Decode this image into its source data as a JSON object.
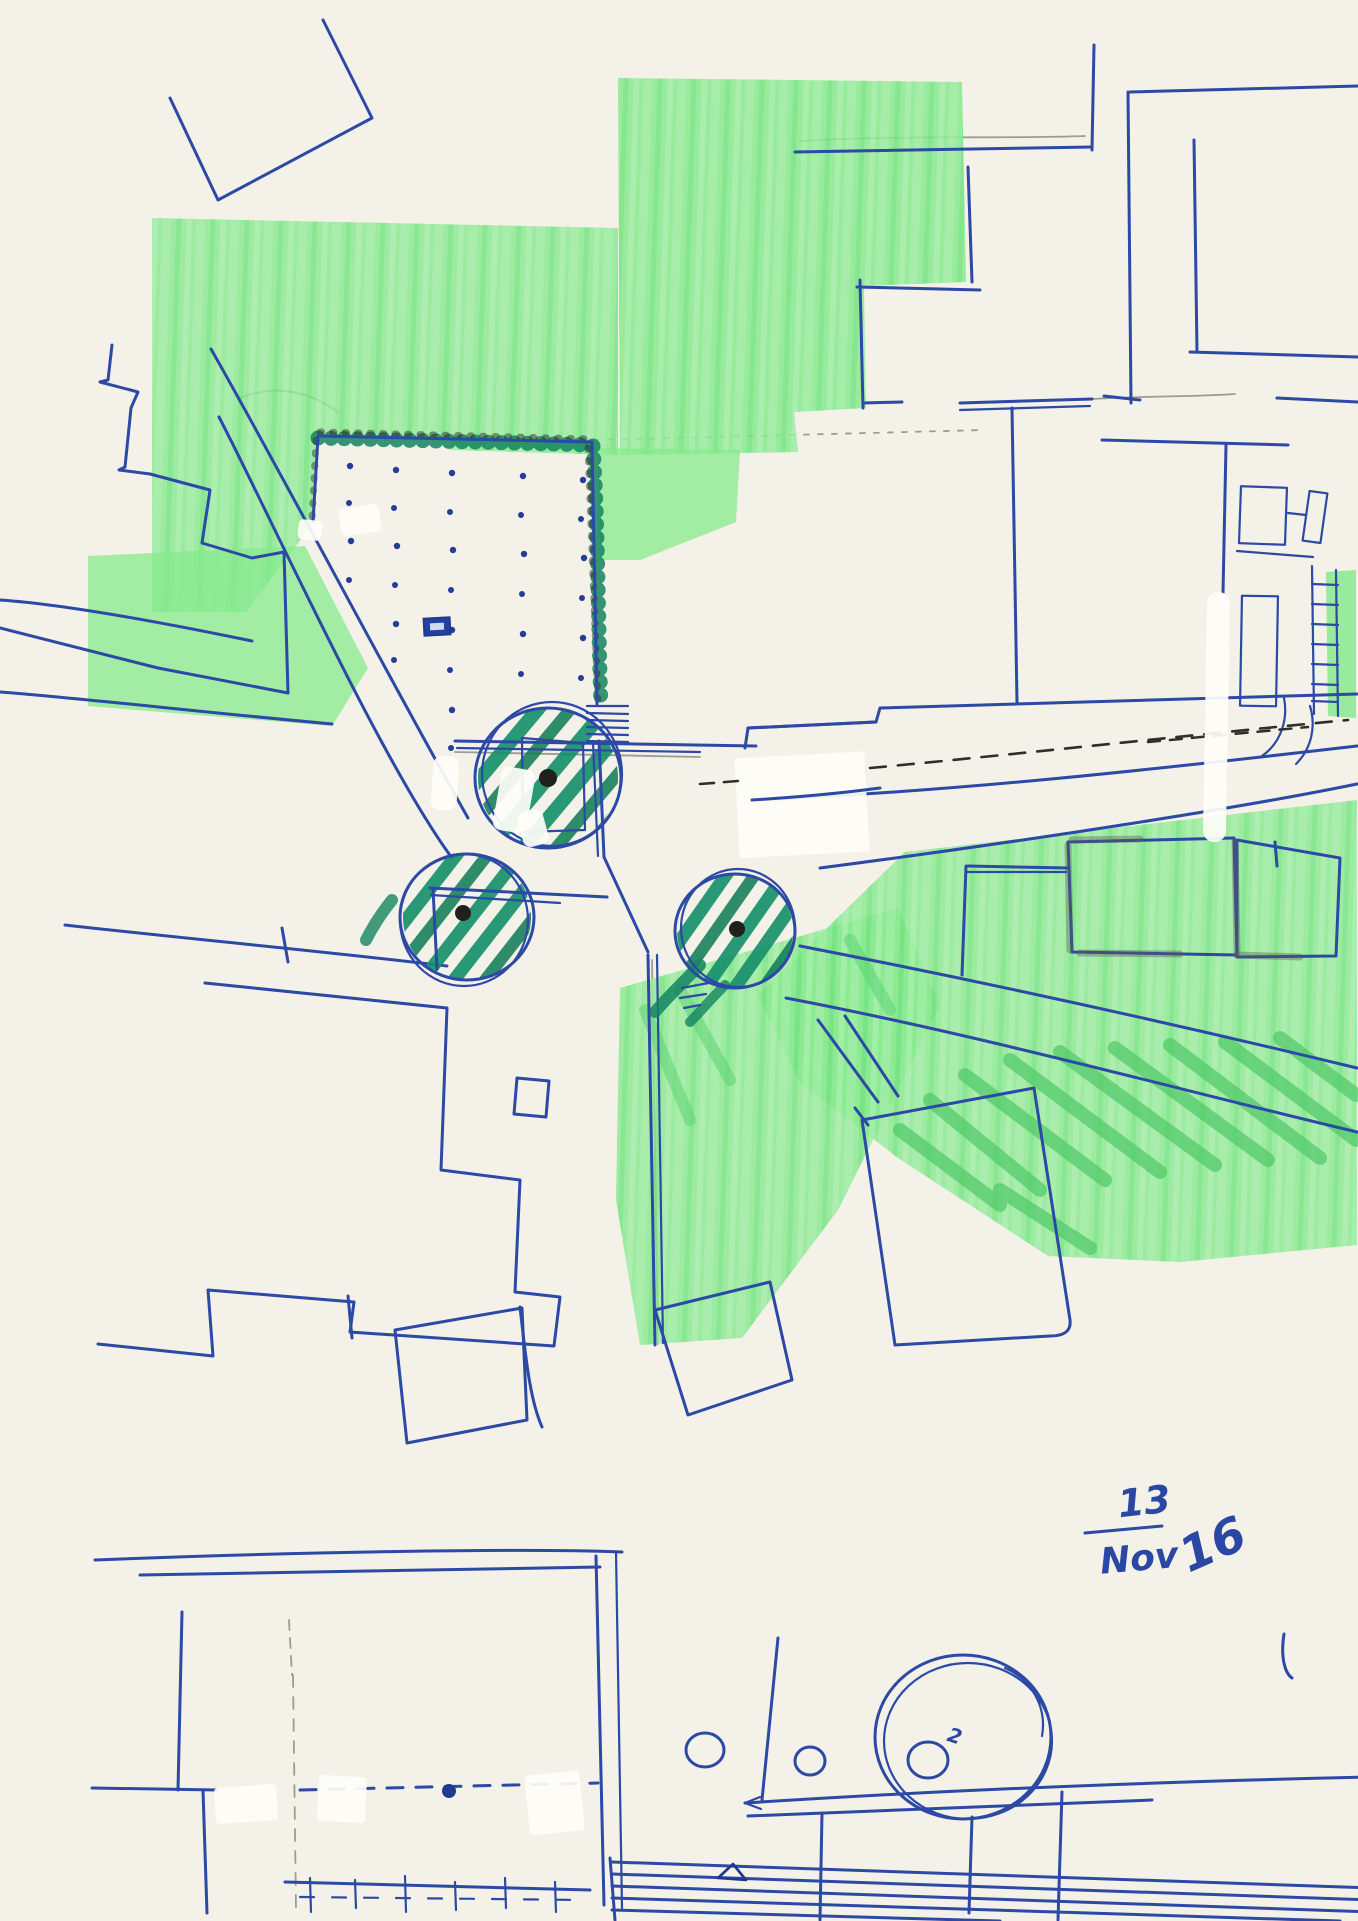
{
  "document": {
    "kind": "hand-drawn urban site plan sketch",
    "medium": "blue ballpoint pen, light and dark green markers, pencil, correction fluid on off-white paper"
  },
  "inscriptions": {
    "date_day": "13",
    "date_month": "Nov",
    "date_year": "16",
    "circle_note": "2"
  },
  "colors": {
    "paper": "#f3f1e8",
    "pen_blue": "#2c49a5",
    "pen_blue_dark": "#20368c",
    "marker_light_green": "#87ea8e",
    "marker_mid_green": "#4fc968",
    "marker_dark_teal": "#17906a",
    "hedge_teal": "#13845f",
    "pencil_gray": "#6e6e64",
    "black_ink": "#2f2f2a",
    "whiteout": "#fefdf8",
    "tree_center_dot": "#20201c"
  },
  "elements": {
    "plaza": "dotted public square with bench and hedge border",
    "trees": "three marker-hatched trees at street intersection",
    "roads": "diagonal avenue, east road with dashed centerline, southeast road",
    "green_areas": "light green marker park and field areas",
    "buildings": "pen-outlined building blocks on all sides",
    "bottom_circles": "two small circles and one large double circle with inner circle",
    "stairs": "hatched stair band at bottom edge",
    "date_note": "handwritten date 13 Nov 16"
  }
}
